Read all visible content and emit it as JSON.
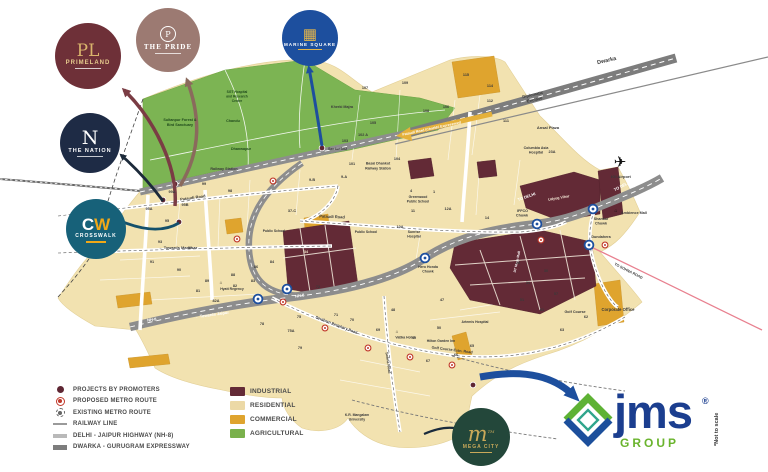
{
  "branding": {
    "jms_name": "jms",
    "jms_reg": "®",
    "jms_group": "GROUP",
    "not_to_scale": "*Not to scale"
  },
  "logos": {
    "primeland": {
      "monogram": "PL",
      "title": "PRIMELAND"
    },
    "the_pride": {
      "monogram": "P",
      "title": "THE PRIDE"
    },
    "the_nation": {
      "monogram": "N",
      "title": "THE NATION"
    },
    "crosswalk": {
      "monogram_c": "C",
      "monogram_w": "W",
      "title": "CROSSWALK"
    },
    "marine_square": {
      "monogram": "▦",
      "title": "MARINE SQUARE"
    },
    "mega_city": {
      "monogram": "m",
      "tm": "TM",
      "title": "MEGA CITY"
    }
  },
  "legend": {
    "items": [
      {
        "type": "dot",
        "label": "PROJECTS BY PROMOTERS"
      },
      {
        "type": "metro-proposed",
        "label": "PROPOSED METRO ROUTE"
      },
      {
        "type": "metro-existing",
        "label": "EXISTING METRO ROUTE"
      },
      {
        "type": "rail",
        "label": "RAILWAY LINE"
      },
      {
        "type": "hwy",
        "label": "DELHI - JAIPUR HIGHWAY (NH-8)"
      },
      {
        "type": "expwy",
        "label": "DWARKA - GURUGRAM EXPRESSWAY"
      }
    ],
    "zones": [
      {
        "color": "#632a36",
        "label": "INDUSTRIAL"
      },
      {
        "color": "#ecd9a6",
        "label": "RESIDENTIAL"
      },
      {
        "color": "#dfa42e",
        "label": "COMMERCIAL"
      },
      {
        "color": "#7ab14c",
        "label": "AGRICULTURAL"
      }
    ]
  },
  "colors": {
    "industrial": "#632a36",
    "residential": "#f2e2b0",
    "commercial": "#dfa42e",
    "agricultural": "#7cb453",
    "road": "#8d8d8d",
    "metro_blue": "#1d4f9e",
    "metro_red": "#c0392b",
    "jms_blue": "#1b3e8f",
    "jms_green": "#6ab42d"
  },
  "map": {
    "labels": [
      {
        "t": "Dwarka",
        "x": 607,
        "y": 62,
        "s": 5.5,
        "r": -13,
        "w": 700
      },
      {
        "t": "Diplomatic",
        "x": 533,
        "y": 96,
        "s": 4.2,
        "r": -13
      },
      {
        "t": "Enclave",
        "x": 535,
        "y": 101,
        "s": 4.2,
        "r": -13
      },
      {
        "t": "Ansal Plaza",
        "x": 548,
        "y": 129,
        "s": 4,
        "w": 700
      },
      {
        "t": "Columbia Asia",
        "x": 536,
        "y": 149,
        "s": 3.6
      },
      {
        "t": "Hospital",
        "x": 536,
        "y": 153.5,
        "s": 3.6
      },
      {
        "t": "Pataudi Road (Charkhi Expressway)",
        "x": 432,
        "y": 129.5,
        "s": 3.5,
        "r": -12,
        "c": "#ffffff"
      },
      {
        "t": "TO DELHI",
        "x": 527,
        "y": 198,
        "s": 4,
        "r": -20,
        "c": "#ffffff",
        "w": 700
      },
      {
        "t": "TO DELHI",
        "x": 623,
        "y": 187,
        "s": 4,
        "r": -27,
        "c": "#ffffff",
        "w": 700
      },
      {
        "t": "✈",
        "x": 620,
        "y": 167,
        "s": 15,
        "c": "#101010",
        "w": 400
      },
      {
        "t": "IGI Airport",
        "x": 621,
        "y": 178,
        "s": 4,
        "w": 600
      },
      {
        "t": "Sultanpur Forest &",
        "x": 180,
        "y": 121,
        "s": 3.7,
        "c": "#1f4a1c",
        "w": 700
      },
      {
        "t": "Bird Sanctuary",
        "x": 180,
        "y": 126,
        "s": 3.7,
        "c": "#1f4a1c",
        "w": 700
      },
      {
        "t": "Chandu",
        "x": 233,
        "y": 122,
        "s": 3.7,
        "c": "#1f4a1c"
      },
      {
        "t": "Dhanwapur",
        "x": 241,
        "y": 150,
        "s": 3.7,
        "c": "#1f4a1c"
      },
      {
        "t": "SGT Hospital",
        "x": 237,
        "y": 93,
        "s": 3.3,
        "c": "#1f4a1c"
      },
      {
        "t": "and Research",
        "x": 237,
        "y": 97.5,
        "s": 3.3,
        "c": "#1f4a1c"
      },
      {
        "t": "Centre",
        "x": 237,
        "y": 102,
        "s": 3.3,
        "c": "#1f4a1c"
      },
      {
        "t": "Railway Station",
        "x": 224,
        "y": 170,
        "s": 3.7,
        "w": 600
      },
      {
        "t": "Kherki Majra",
        "x": 342,
        "y": 108,
        "s": 3.7
      },
      {
        "t": "Sector 102",
        "x": 328,
        "y": 150,
        "s": 3.8,
        "w": 700,
        "a": "start"
      },
      {
        "t": "Basai Dhankot",
        "x": 378,
        "y": 164.5,
        "s": 3.5
      },
      {
        "t": "Railway Station",
        "x": 378,
        "y": 169.5,
        "s": 3.5
      },
      {
        "t": "Pataudi Road",
        "x": 193,
        "y": 199,
        "s": 4,
        "r": -8,
        "w": 600
      },
      {
        "t": "Pataudi Road",
        "x": 332,
        "y": 218,
        "s": 4,
        "r": 2,
        "w": 600
      },
      {
        "t": "← Towards Manesar",
        "x": 178,
        "y": 249,
        "s": 4,
        "w": 700
      },
      {
        "t": "NH-8",
        "x": 152,
        "y": 321,
        "s": 4,
        "r": -8,
        "c": "#ffffff",
        "w": 700
      },
      {
        "t": "← Towards Jaipur",
        "x": 212,
        "y": 316,
        "s": 4,
        "r": -8,
        "c": "#ffffff",
        "w": 600
      },
      {
        "t": "NH-8",
        "x": 300,
        "y": 297,
        "s": 4,
        "r": -10,
        "c": "#ffffff",
        "w": 700
      },
      {
        "t": "Greenwood",
        "x": 418,
        "y": 198,
        "s": 3.4
      },
      {
        "t": "Public School",
        "x": 418,
        "y": 202.5,
        "s": 3.4
      },
      {
        "t": "Public School",
        "x": 274,
        "y": 232,
        "s": 3.4
      },
      {
        "t": "Public School",
        "x": 366,
        "y": 233,
        "s": 3.4
      },
      {
        "t": "Sunrise",
        "x": 414,
        "y": 233,
        "s": 3.4
      },
      {
        "t": "Hospital",
        "x": 414,
        "y": 237.5,
        "s": 3.4
      },
      {
        "t": "IFFCO",
        "x": 528,
        "y": 212,
        "s": 3.7,
        "w": 700,
        "a": "end"
      },
      {
        "t": "Chowk",
        "x": 528,
        "y": 216.5,
        "s": 3.7,
        "w": 700,
        "a": "end"
      },
      {
        "t": "Shankar",
        "x": 601,
        "y": 220,
        "s": 3.7,
        "w": 700
      },
      {
        "t": "Chowk",
        "x": 601,
        "y": 224.5,
        "s": 3.7,
        "w": 700
      },
      {
        "t": "Dundahera",
        "x": 601,
        "y": 238,
        "s": 3.7,
        "w": 600
      },
      {
        "t": "⌂",
        "x": 616,
        "y": 212,
        "s": 5,
        "c": "#101010"
      },
      {
        "t": "Ambience Mall",
        "x": 621,
        "y": 214,
        "s": 3.7,
        "a": "start",
        "w": 600
      },
      {
        "t": "Udyog Vihar",
        "x": 559,
        "y": 199,
        "s": 3.7,
        "r": -10,
        "c": "#f3e6d5",
        "w": 600
      },
      {
        "t": "DT Mega Mall",
        "x": 518,
        "y": 262,
        "s": 3.4,
        "r": -78,
        "c": "#ffffff",
        "w": 600
      },
      {
        "t": "TO SOHNA ROAD",
        "x": 628,
        "y": 272,
        "s": 3.7,
        "r": 27,
        "w": 700
      },
      {
        "t": "Corporate Office",
        "x": 618,
        "y": 311,
        "s": 4.2,
        "w": 700
      },
      {
        "t": "Golf Course",
        "x": 575,
        "y": 313,
        "s": 3.7
      },
      {
        "t": "Southern Periphery Road",
        "x": 336,
        "y": 326,
        "s": 3.7,
        "r": 21,
        "w": 600
      },
      {
        "t": "Golf Course Extn. Road",
        "x": 452,
        "y": 351,
        "s": 3.7,
        "r": 7,
        "w": 600
      },
      {
        "t": "Sohna Road",
        "x": 387,
        "y": 363,
        "s": 3.7,
        "r": 82,
        "w": 600
      },
      {
        "t": "Hero Honda",
        "x": 428,
        "y": 268,
        "s": 3.5,
        "w": 700
      },
      {
        "t": "Chowk",
        "x": 428,
        "y": 272.5,
        "s": 3.5,
        "w": 700
      },
      {
        "t": "⌂",
        "x": 221,
        "y": 284,
        "s": 4.5,
        "c": "#101010"
      },
      {
        "t": "Hyatt Regency",
        "x": 232,
        "y": 290,
        "s": 3.4
      },
      {
        "t": "⌂",
        "x": 397,
        "y": 333,
        "s": 4.5,
        "c": "#101010"
      },
      {
        "t": "Vatika Hotel",
        "x": 405,
        "y": 338.5,
        "s": 3.4
      },
      {
        "t": "Hilton Garden Inn",
        "x": 441,
        "y": 342,
        "s": 3.4
      },
      {
        "t": "Artemis Hospital",
        "x": 475,
        "y": 323,
        "s": 3.4
      },
      {
        "t": "K.R. Mangalam",
        "x": 357,
        "y": 416,
        "s": 3.4
      },
      {
        "t": "University",
        "x": 357,
        "y": 420.5,
        "s": 3.4
      }
    ],
    "sectors": [
      [
        "107",
        365,
        89
      ],
      [
        "109",
        405,
        84
      ],
      [
        "115",
        466,
        76
      ],
      [
        "114",
        490,
        87
      ],
      [
        "112",
        490,
        102
      ],
      [
        "111",
        506,
        122
      ],
      [
        "108",
        426,
        112
      ],
      [
        "106",
        446,
        108
      ],
      [
        "105",
        373,
        124
      ],
      [
        "103",
        345,
        142
      ],
      [
        "102 A",
        363,
        136
      ],
      [
        "104",
        397,
        160
      ],
      [
        "101",
        352,
        165
      ],
      [
        "99A",
        172,
        193
      ],
      [
        "99",
        204,
        185
      ],
      [
        "98",
        230,
        192
      ],
      [
        "95B",
        185,
        206
      ],
      [
        "95A",
        149,
        210
      ],
      [
        "95",
        167,
        222
      ],
      [
        "93",
        160,
        243
      ],
      [
        "92",
        190,
        249
      ],
      [
        "91",
        152,
        263
      ],
      [
        "90",
        179,
        271
      ],
      [
        "89",
        207,
        282
      ],
      [
        "88",
        233,
        276
      ],
      [
        "86",
        256,
        268
      ],
      [
        "84",
        272,
        263
      ],
      [
        "83",
        253,
        282
      ],
      [
        "82A",
        216,
        302
      ],
      [
        "82",
        235,
        287
      ],
      [
        "81",
        198,
        292
      ],
      [
        "78",
        262,
        325
      ],
      [
        "79",
        300,
        349
      ],
      [
        "37-C",
        292,
        212
      ],
      [
        "9-B",
        312,
        181
      ],
      [
        "9-A",
        344,
        178
      ],
      [
        "4",
        411,
        192
      ],
      [
        "1",
        434,
        193
      ],
      [
        "12A",
        448,
        210
      ],
      [
        "11",
        413,
        212
      ],
      [
        "14",
        487,
        219
      ],
      [
        "10A",
        400,
        228
      ],
      [
        "23A",
        552,
        153
      ],
      [
        "29",
        518,
        264
      ],
      [
        "30",
        546,
        272
      ],
      [
        "31",
        528,
        284
      ],
      [
        "51",
        522,
        301
      ],
      [
        "57",
        556,
        295
      ],
      [
        "61",
        542,
        311
      ],
      [
        "62",
        586,
        318
      ],
      [
        "63",
        562,
        331
      ],
      [
        "47",
        442,
        301
      ],
      [
        "48",
        393,
        311
      ],
      [
        "49",
        414,
        339
      ],
      [
        "50",
        439,
        329
      ],
      [
        "65",
        472,
        347
      ],
      [
        "66",
        456,
        356
      ],
      [
        "67",
        428,
        362
      ],
      [
        "69",
        378,
        331
      ],
      [
        "70",
        352,
        321
      ],
      [
        "71",
        336,
        316
      ],
      [
        "72",
        318,
        288
      ],
      [
        "75",
        299,
        318
      ],
      [
        "75A",
        291,
        332
      ],
      [
        "34",
        306,
        253,
        "#f2e4c9"
      ]
    ],
    "stations": {
      "existing": [
        [
          537,
          224
        ],
        [
          593,
          209
        ],
        [
          589,
          245
        ],
        [
          425,
          258
        ],
        [
          287,
          289
        ],
        [
          258,
          299
        ]
      ],
      "proposed": [
        [
          273,
          181
        ],
        [
          237,
          239
        ],
        [
          283,
          302
        ],
        [
          325,
          328
        ],
        [
          368,
          348
        ],
        [
          410,
          357
        ],
        [
          452,
          365
        ],
        [
          605,
          245
        ],
        [
          541,
          240
        ]
      ],
      "projects": [
        [
          163,
          200
        ],
        [
          175,
          184
        ],
        [
          179,
          222
        ],
        [
          322,
          148
        ],
        [
          473,
          385
        ]
      ]
    }
  }
}
